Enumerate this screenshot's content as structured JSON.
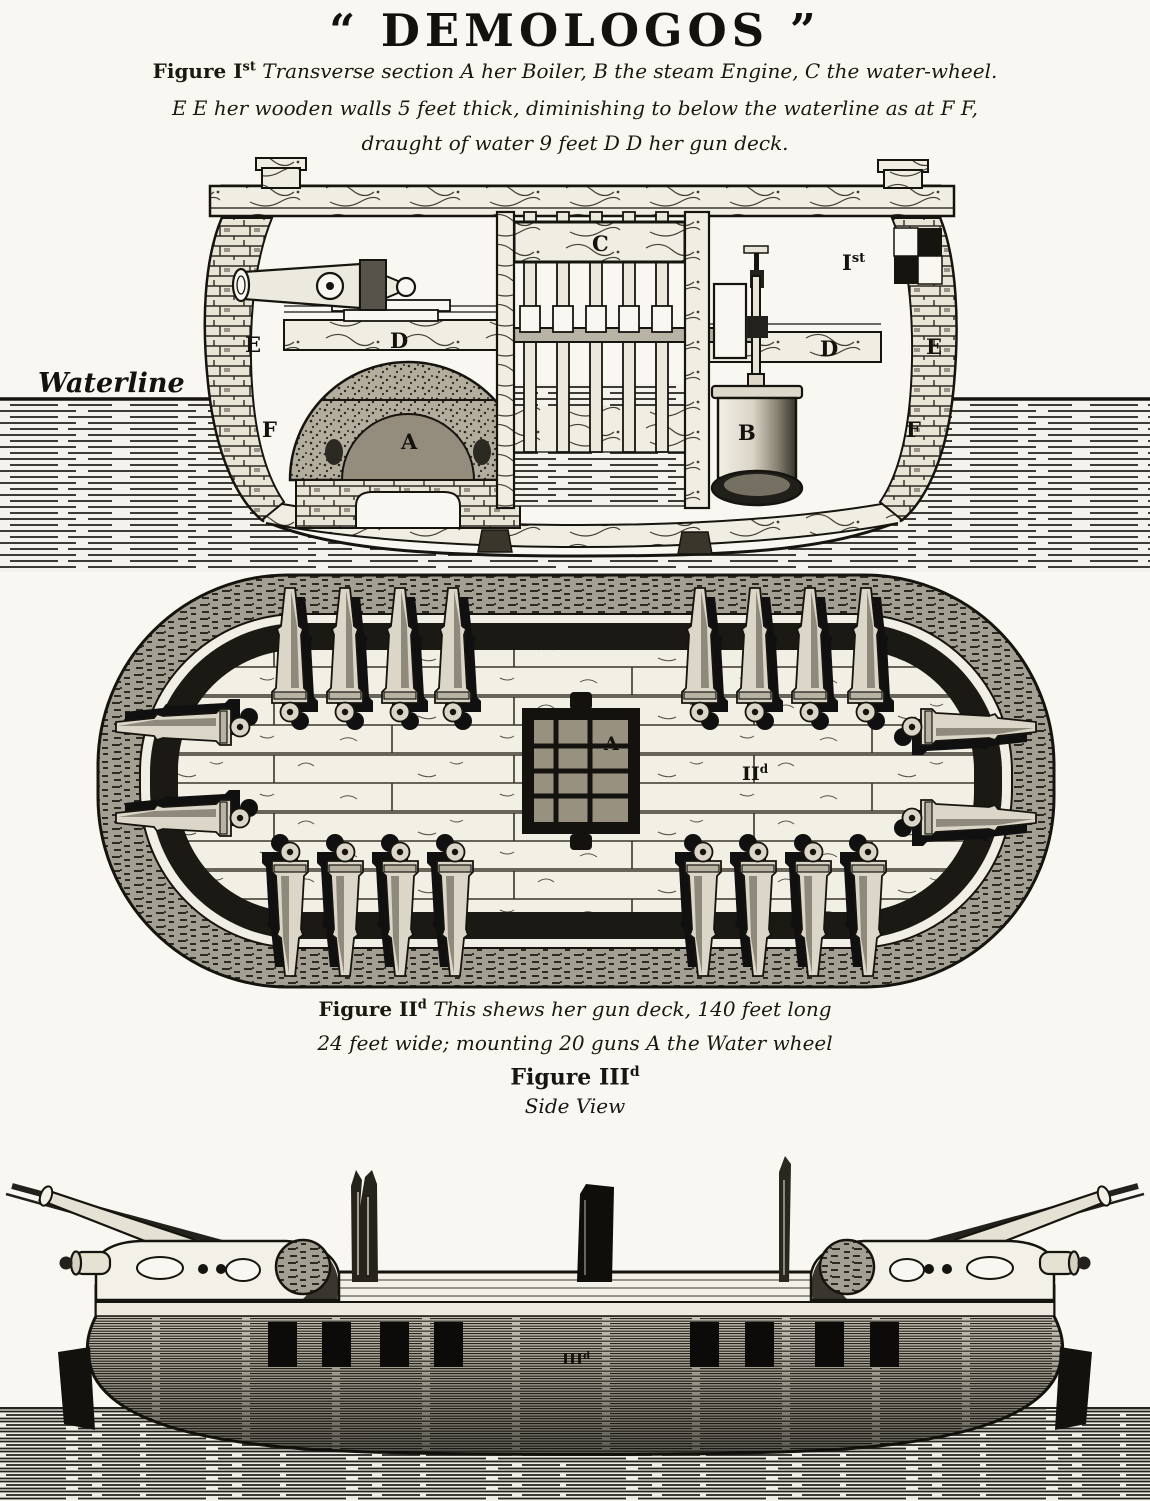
{
  "palette": {
    "paper": "#f8f7f2",
    "ink": "#14120d",
    "mottle_gray": "#a49f93",
    "deck_plank": "#f2efe5"
  },
  "title": "“ DEMOLOGOS ”",
  "fig1": {
    "caption": {
      "l1_pre": "Figure I",
      "l1_sup": "st",
      "l1_post": " Transverse section A her Boiler, B the steam Engine, C the water-wheel.",
      "l2": "E E her wooden walls 5 feet thick, diminishing to below the waterline as at F F,",
      "l3": "draught of water 9 feet D D her gun deck."
    },
    "labels": {
      "waterline": "Waterline",
      "e_left": "E",
      "d_left": "D",
      "c": "C",
      "ref_pre": "I",
      "ref_sup": "st",
      "d_right": "D",
      "e_right": "E",
      "f_left": "F",
      "f_right": "F",
      "a": "A",
      "b": "B"
    }
  },
  "fig2": {
    "caption": {
      "l1_pre": "Figure II",
      "l1_sup": "d",
      "l1_post": " This shews her gun deck, 140 feet long",
      "l2": "24 feet wide; mounting 20 guns A the Water wheel"
    },
    "labels": {
      "a": "A",
      "ref_pre": "II",
      "ref_sup": "d"
    }
  },
  "fig3": {
    "heading_pre": "Figure III",
    "heading_sup": "d",
    "subheading": "Side View",
    "labels": {
      "ref_pre": "III",
      "ref_sup": "d"
    }
  }
}
